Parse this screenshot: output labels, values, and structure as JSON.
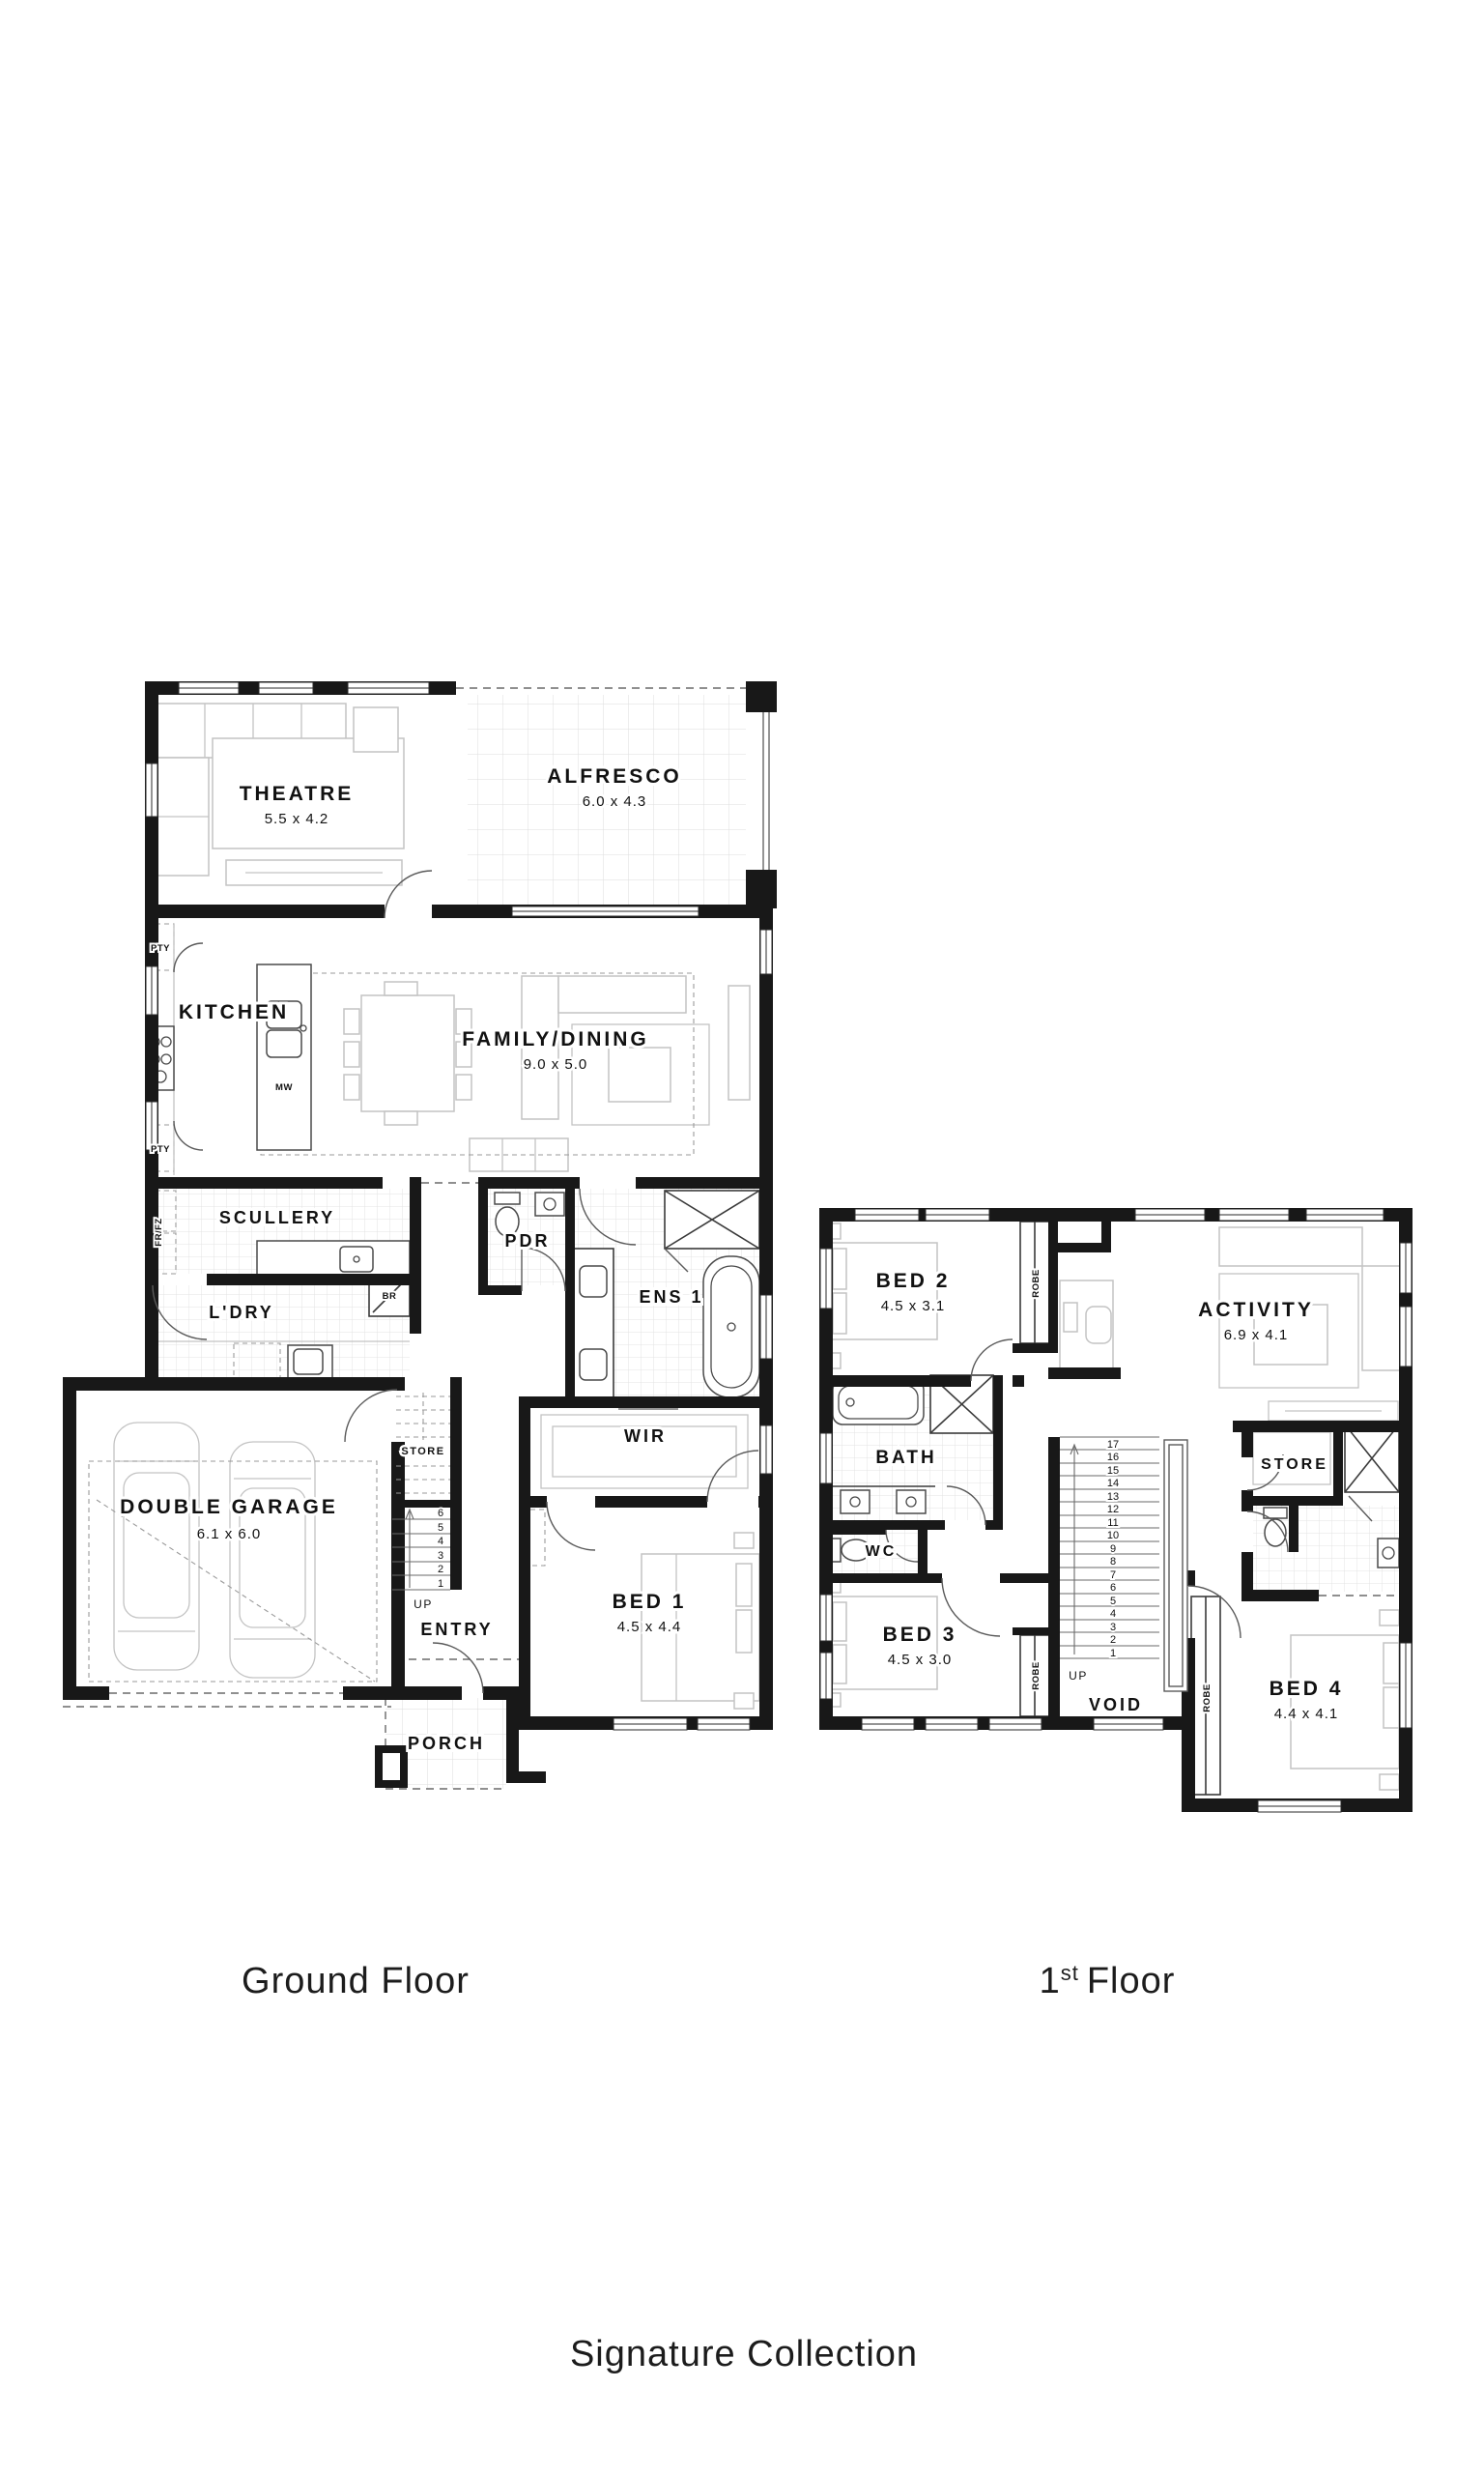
{
  "captions": {
    "ground": "Ground Floor",
    "first_num": "1",
    "first_sup": "st",
    "first_word": "Floor",
    "collection": "Signature Collection"
  },
  "ground": {
    "theatre_name": "THEATRE",
    "theatre_dims": "5.5 x 4.2",
    "alfresco_name": "ALFRESCO",
    "alfresco_dims": "6.0 x 4.3",
    "kitchen_name": "KITCHEN",
    "family_name": "FAMILY/DINING",
    "family_dims": "9.0 x 5.0",
    "scullery_name": "SCULLERY",
    "pdr_name": "PDR",
    "ens1_name": "ENS 1",
    "ldry_name": "L'DRY",
    "store_name": "STORE",
    "wir_name": "WIR",
    "entry_name": "ENTRY",
    "bed1_name": "BED 1",
    "bed1_dims": "4.5 x 4.4",
    "garage_name": "DOUBLE GARAGE",
    "garage_dims": "6.1 x 6.0",
    "porch_name": "PORCH",
    "pty": "PTY",
    "frfz": "FR/FZ",
    "mw": "MW",
    "br": "BR",
    "up": "UP",
    "stairs": [
      "6",
      "5",
      "4",
      "3",
      "2",
      "1"
    ]
  },
  "first": {
    "bed2_name": "BED 2",
    "bed2_dims": "4.5 x 3.1",
    "activity_name": "ACTIVITY",
    "activity_dims": "6.9 x 4.1",
    "bath_name": "BATH",
    "wc_name": "WC",
    "store_name": "STORE",
    "bed3_name": "BED 3",
    "bed3_dims": "4.5 x 3.0",
    "bed4_name": "BED 4",
    "bed4_dims": "4.4 x 4.1",
    "void_name": "VOID",
    "robe": "ROBE",
    "up": "UP",
    "stairs": [
      "17",
      "16",
      "15",
      "14",
      "13",
      "12",
      "11",
      "10",
      "9",
      "8",
      "7",
      "6",
      "5",
      "4",
      "3",
      "2",
      "1"
    ]
  }
}
